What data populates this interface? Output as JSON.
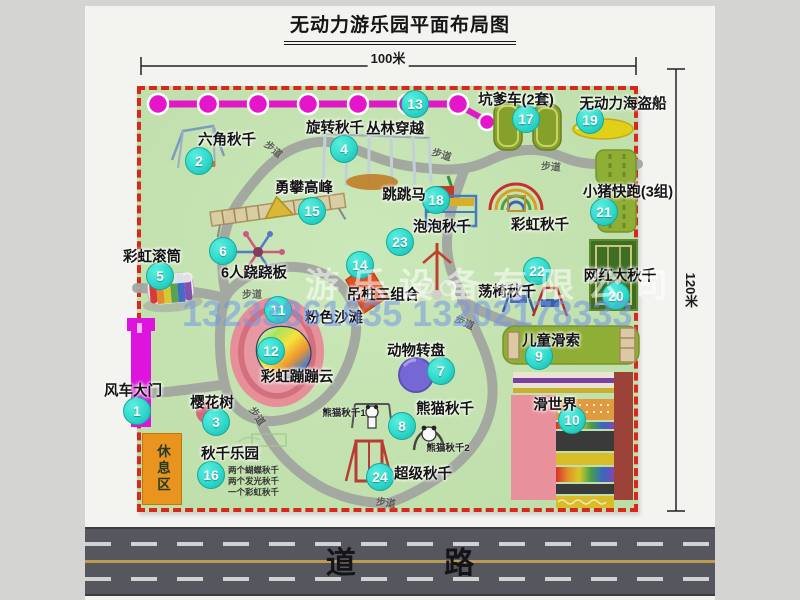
{
  "title": "无动力游乐园平面布局图",
  "dimensions": {
    "width_label": "100米",
    "height_label": "120米"
  },
  "road": {
    "label": "道 路"
  },
  "walkway_label": "步道",
  "watermark": {
    "company": "游乐设备有限公司",
    "phone": "13233861635 13202178333"
  },
  "rest_area_label": "休息区",
  "rainbow_swing_label": "彩虹秋千",
  "panda_sub1": "熊猫秋千1",
  "panda_sub2": "熊猫秋千2",
  "swing_park_notes": [
    "两个蝴蝶秋千",
    "两个发光秋千",
    "一个彩虹秋千"
  ],
  "features": [
    {
      "num": "1",
      "label": "风车大门"
    },
    {
      "num": "2",
      "label": "六角秋千"
    },
    {
      "num": "3",
      "label": "樱花树"
    },
    {
      "num": "4",
      "label": "旋转秋千"
    },
    {
      "num": "5",
      "label": "彩虹滚筒"
    },
    {
      "num": "6",
      "label": "6人跷跷板"
    },
    {
      "num": "7",
      "label": "动物转盘"
    },
    {
      "num": "8",
      "label": "熊猫秋千"
    },
    {
      "num": "9",
      "label": "儿童滑索"
    },
    {
      "num": "10",
      "label": "滑世界"
    },
    {
      "num": "11",
      "label": "粉色沙滩"
    },
    {
      "num": "12",
      "label": "彩虹蹦蹦云"
    },
    {
      "num": "13",
      "label": "丛林穿越"
    },
    {
      "num": "14",
      "label": "吊桩三组合"
    },
    {
      "num": "15",
      "label": "勇攀高峰"
    },
    {
      "num": "16",
      "label": "秋千乐园"
    },
    {
      "num": "17",
      "label": "坑爹车(2套)"
    },
    {
      "num": "18",
      "label": "跳跳马"
    },
    {
      "num": "19",
      "label": "无动力海盗船"
    },
    {
      "num": "20",
      "label": "网红大秋千"
    },
    {
      "num": "21",
      "label": "小猪快跑(3组)"
    },
    {
      "num": "22",
      "label": "荡椅秋千"
    },
    {
      "num": "23",
      "label": "泡泡秋千"
    },
    {
      "num": "24",
      "label": "超级秋千"
    }
  ],
  "colors": {
    "park_green": "#c4e3b2",
    "border_red": "#d8281e",
    "marker_teal": "#2fd9cb",
    "chain_magenta": "#e018c8",
    "path_gray": "#a2a6a0",
    "road_gray": "#56565e",
    "rest_orange": "#e8941e",
    "mat_olive": "#8fae35",
    "beach_pink": "#e78f99"
  }
}
